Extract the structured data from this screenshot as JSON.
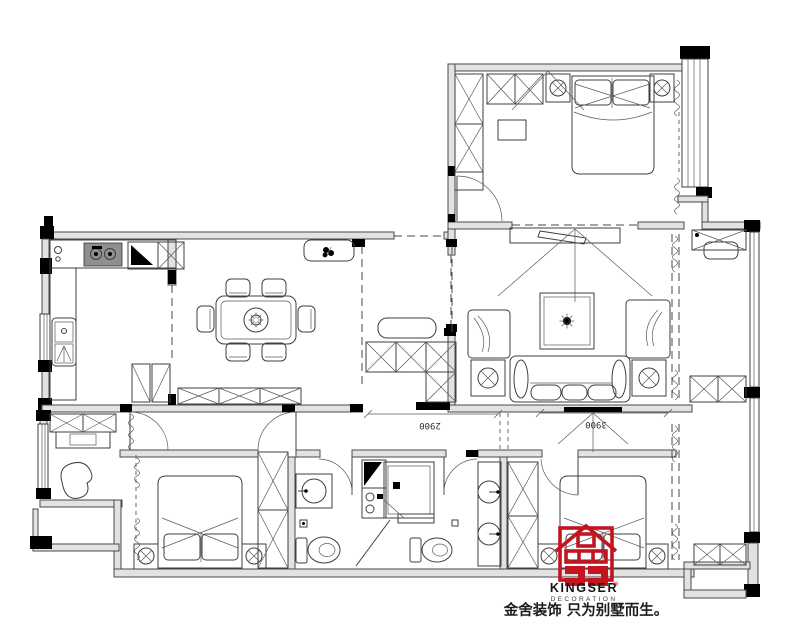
{
  "branding": {
    "brand_name": "KINGSER",
    "registered_mark": "®",
    "brand_subtitle": "DECORATION",
    "slogan": "金舍装饰 只为别墅而生。",
    "logo_color": "#c41420"
  },
  "dimension_labels": {
    "left": "2900",
    "right": "3900"
  },
  "palette": {
    "background": "#ffffff",
    "line": "#3f3f3f",
    "wall_fill": "#e2e2e2",
    "column": "#000000",
    "logo_red": "#c41420",
    "text": "#1a1a1a"
  },
  "icon_names": [
    "bed-icon",
    "pillow-icon",
    "nightstand-lamp-icon",
    "wardrobe-icon",
    "sofa-icon",
    "armchair-icon",
    "rug-icon",
    "tv-cabinet-icon",
    "dining-table-icon",
    "chair-icon",
    "stove-icon",
    "fridge-icon",
    "kitchen-sink-icon",
    "basin-icon",
    "toilet-icon",
    "shower-icon",
    "washer-icon",
    "plant-icon",
    "door-arc-icon",
    "window-icon",
    "curtain-icon",
    "desk-icon",
    "study-chair-icon",
    "shoe-cabinet-icon",
    "bench-icon",
    "laundry-counter-icon",
    "balcony-cabinet-icon"
  ]
}
